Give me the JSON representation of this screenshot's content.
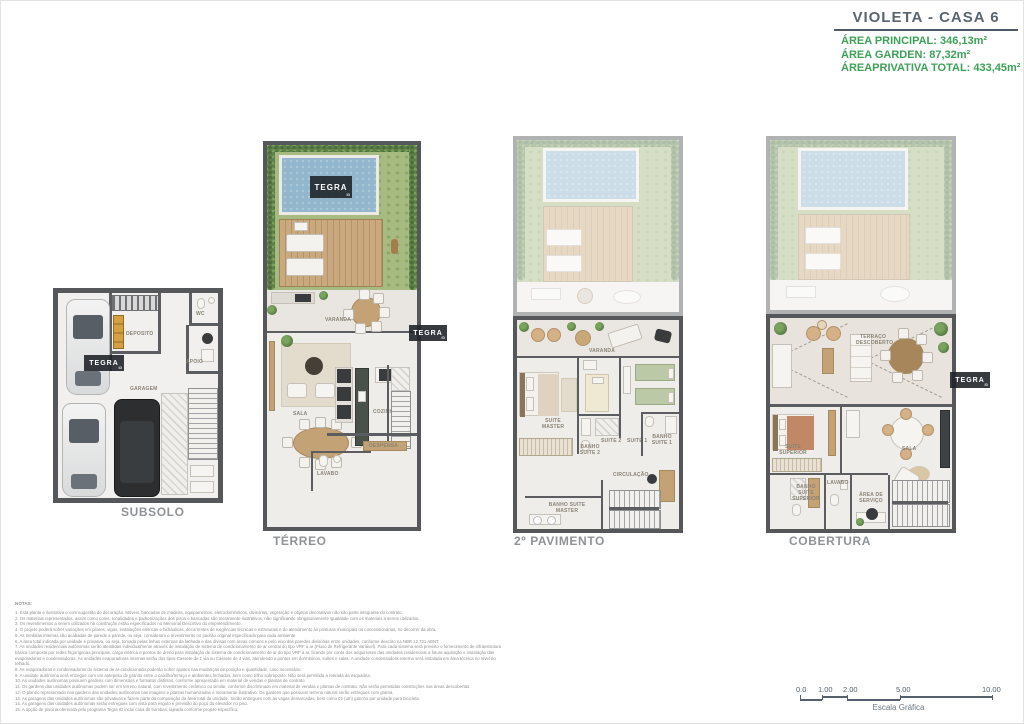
{
  "header": {
    "title": "VIOLETA - CASA 6",
    "area_principal": "ÁREA PRINCIPAL: 346,13m²",
    "area_garden": "ÁREA GARDEN: 87,32m²",
    "area_privativa": "ÁREAPRIVATIVA TOTAL: 433,45m²"
  },
  "watermark": {
    "brand": "TEGRA",
    "sub": "ID"
  },
  "floors": {
    "subsolo": {
      "title": "SUBSOLO",
      "rooms": {
        "wc": "WC",
        "deposito": "DEPOSITO",
        "apoio": "APOIO",
        "garagem": "GARAGEM"
      }
    },
    "terreo": {
      "title": "TÉRREO",
      "rooms": {
        "varanda": "VARANDA",
        "sala": "SALA",
        "cozinha": "COZINHA",
        "despensa": "DESPENSA",
        "lavabo": "LAVABO"
      }
    },
    "pavimento2": {
      "title": "2º PAVIMENTO",
      "rooms": {
        "varanda": "VARANDA",
        "suite_master": "SUITE MASTER",
        "suite_2": "SUITE 2",
        "suite_1": "SUITE 1",
        "banho_suite_2": "BANHO SUITE 2",
        "banho_suite_1": "BANHO SUITE 1",
        "circulacao": "CIRCULAÇÃO",
        "banho_suite_master": "BANHO SUITE MASTER"
      }
    },
    "cobertura": {
      "title": "COBERTURA",
      "rooms": {
        "terraco": "TERRAÇO DESCOBERTO",
        "suite_superior": "SUITE SUPERIOR",
        "sala": "SALA",
        "lavabo": "LAVABO",
        "banho_suite_superior": "BANHO SUITE SUPERIOR",
        "area_servico": "ÁREA DE SERVIÇO"
      }
    }
  },
  "notes": {
    "heading": "NOTAS:",
    "items": [
      "1. Esta planta é ilustrativa e com sugestão de decoração. Móveis, bancadas de madeira, equipamentos, eletrodomésticos, divisórias, vegetação e objetos decorativos não são parte integrante do contrato.",
      "2. Os materiais representados, assim como cores, tonalidades e padronizações dos pisos e bancadas são meramente ilustrativos, não significando obrigatoriamente igualdade com os materiais a serem utilizados.",
      "3. Os revestimentos a serem utilizados na construção estão especificados no Memorial Descritivo do empreendimento.",
      "4. O projeto poderá sofrer variações em pilares, vigas, instalações elétricas e hidráulicas, decorrentes de exigências técnicas e estruturais e do atendimento às posturas municipais ou concessionárias, no decorrer da obra.",
      "5. As medidas internas são acabadas de parede a parede, ou seja, consideram o revestimento no padrão original especificado para cada ambiente.",
      "6. A área total indicada por unidade é privativa, ou seja, tomada pelas linhas externas da fachada e das divisas com áreas comuns e pelo eixo das paredes divisórias entre unidades, conforme descrito na NBR 12.721 ABNT.",
      "7. As unidades residenciais autônomas serão atendidas individualmente através de instalação de sistema de condicionamento de ar central do tipo VRF a ar (Fluxo de Refrigerante Variável). Para cada sistema será previsto o fornecimento de infraestrutura básica composta por redes frigorígenas principais, carga elétrica e pontos de dreno para instalação de sistema de condicionamento de ar do tipo VRF a ar, ficando por conta dos adquirentes das unidades residenciais a futura aquisição e instalação das evaporadoras e condensadoras. As unidades evaporadoras internas serão dos tipos Cassete de 1 via ou Cassete de 4 vias, atendendo a pontos em dormitórios, suítes e salas. A unidade condensadora externa será instalada em área técnica no nível do telhado.",
      "8. As evaporadoras e condensadoras do sistema de ar-condicionado poderão sofrer ajustes nas mudanças de posição e quantidade, caso necessário.",
      "9. A unidade autônoma será entregue com um antepeito de granito entre o caixilho/terraço e ambientes fechados, bem como trilho sobreposto. Não será permitida a retirada da esquadria.",
      "10. As unidades autônomas possuem gardens com dimensões e formatos distintos, conforme apresentado em material de vendas e plantas de contrato.",
      "11. Os gardens das unidades autônomas podem ser em terreno natural, com revestimento cerâmico ou similar, conforme discriminado em material de vendas e plantas de contrato. Não serão permitidas construções nas áreas descobertas.",
      "12. O plantio representado nos gardens das unidades autônomas nas imagens e plantas humanizadas é meramente ilustrativo. Os gardens que possuem terreno natural serão entregues com grama.",
      "13. As garagens das unidades autônomas são privativas e fazem parte da composição da área total da unidade. Serão entregues com as vagas demarcadas, bem como 01 (um) gancho por unidade para bicicleta.",
      "14. As garagens das unidades autônomas serão entregues com vista para esgoto e previsão do poço do elevador no piso.",
      "15. A opção de piscina oferecida pelo programa Tegra ID inclui casa de bombas, lajeada conforme projeto específico."
    ]
  },
  "scale": {
    "ticks": [
      "0.0",
      "1.00",
      "2.00",
      "5.00",
      "10.00"
    ],
    "label": "Escala Gráfica"
  }
}
